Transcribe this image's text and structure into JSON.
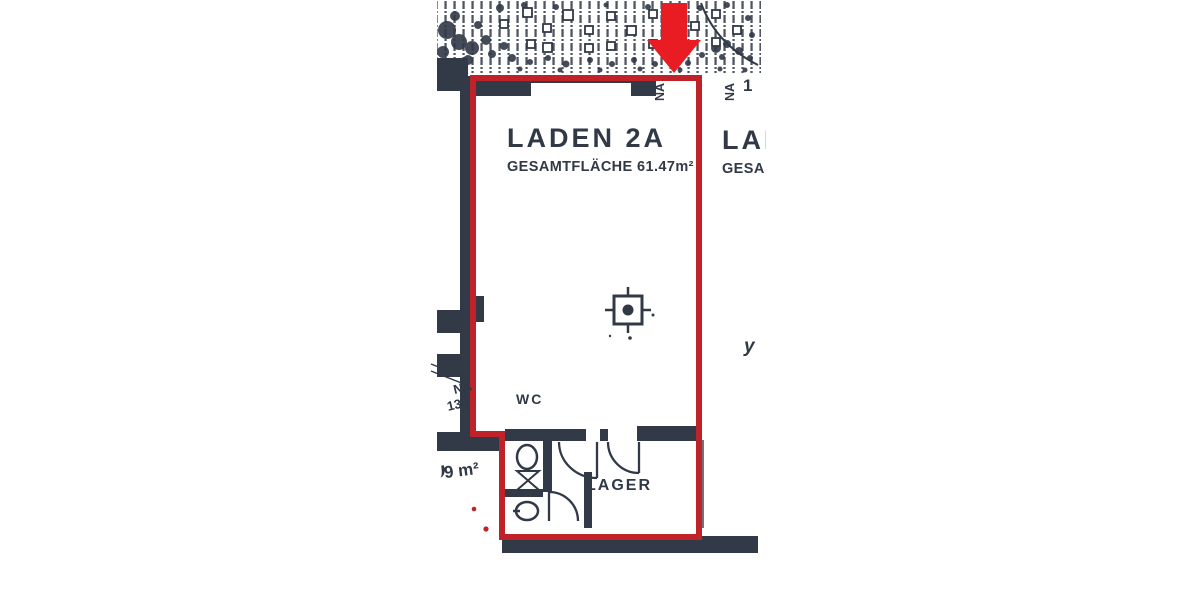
{
  "plan": {
    "unit": {
      "name": "LADEN 2A",
      "area_label": "GESAMTFLÄCHE 61.47m²"
    },
    "neighbor": {
      "name_partial": "LAD",
      "area_partial": "GESA"
    },
    "rooms": {
      "wc_label": "WC",
      "storage_label": "LAGER"
    },
    "annotations": {
      "duct_label_line1": "NA",
      "duct_label_line2": "130",
      "left_area_partial": "9 m²",
      "top_vent_left": "NA",
      "top_vent_right": "NA",
      "top_right_digit": "1",
      "handwritten_mark": "y"
    },
    "colors": {
      "ink": "#313947",
      "boundary_red": "#bf2229",
      "arrow_red": "#ea1c23"
    }
  }
}
